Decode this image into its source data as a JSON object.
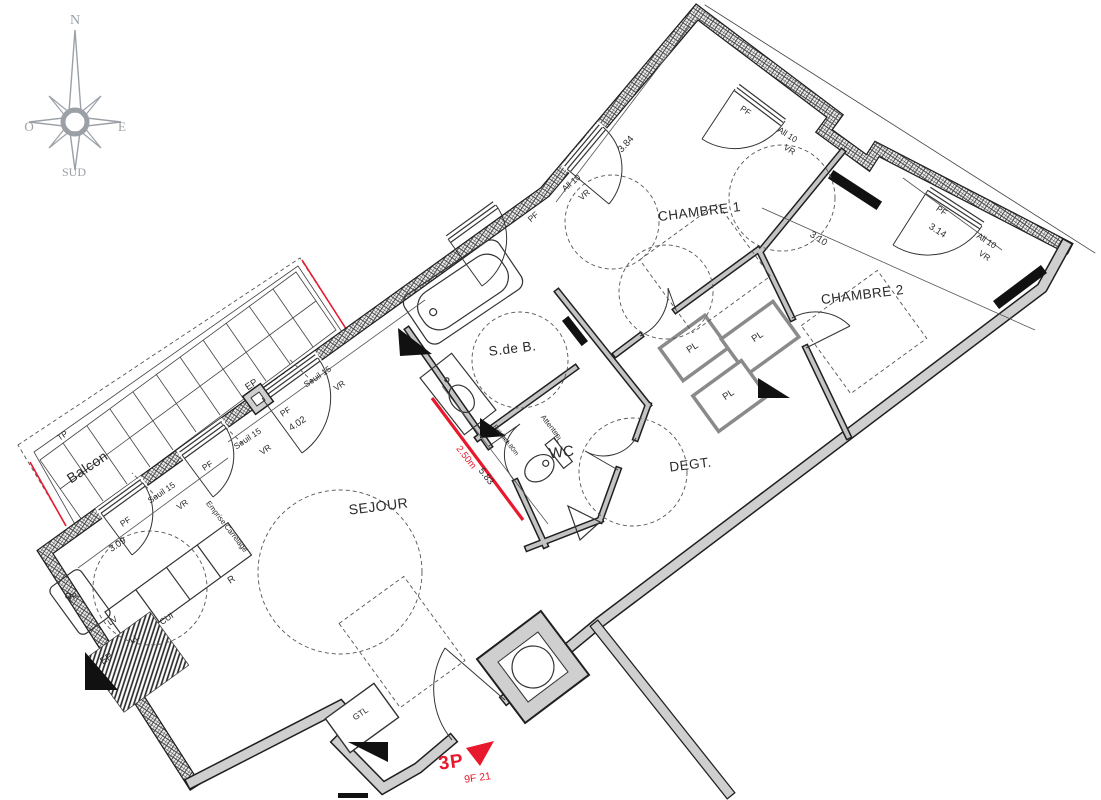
{
  "unit": {
    "type": "3P",
    "code": "9F 21"
  },
  "compass": {
    "n": "N",
    "o": "O",
    "e": "E",
    "s": "SUD"
  },
  "rooms": {
    "sejour": "SEJOUR",
    "chambre1": "CHAMBRE 1",
    "chambre2": "CHAMBRE 2",
    "sdb": "S.de B.",
    "wc": "WC",
    "degt": "DEGT.",
    "balcon": "Balcon"
  },
  "dims": {
    "d384": "3.84",
    "d310": "3.10",
    "d314": "3.14",
    "d402": "4.02",
    "d309": "3.09",
    "d583": "5.83",
    "d250": "2.50m"
  },
  "labels": {
    "pf": "PF",
    "vr": "VR",
    "all10": "All 10",
    "seuil15": "Seuil 15",
    "ep": "EP",
    "tp": "TP",
    "tri": "TRI",
    "lv": "LV",
    "ll": "LL",
    "cui": "CUI",
    "r": "R",
    "gtl": "GTL",
    "pl": "PL",
    "attentes": "Attentes",
    "attentes_ll": "LL",
    "faience1": "Faïence",
    "faience2": "h=1.80m",
    "emprise": "Emprise Carrelage"
  },
  "colors": {
    "marker_red": "#e8192c",
    "wall_dark": "#1f1f1f",
    "wall_gray": "#cfcfcf",
    "compass_gray": "#9aa0a6"
  }
}
